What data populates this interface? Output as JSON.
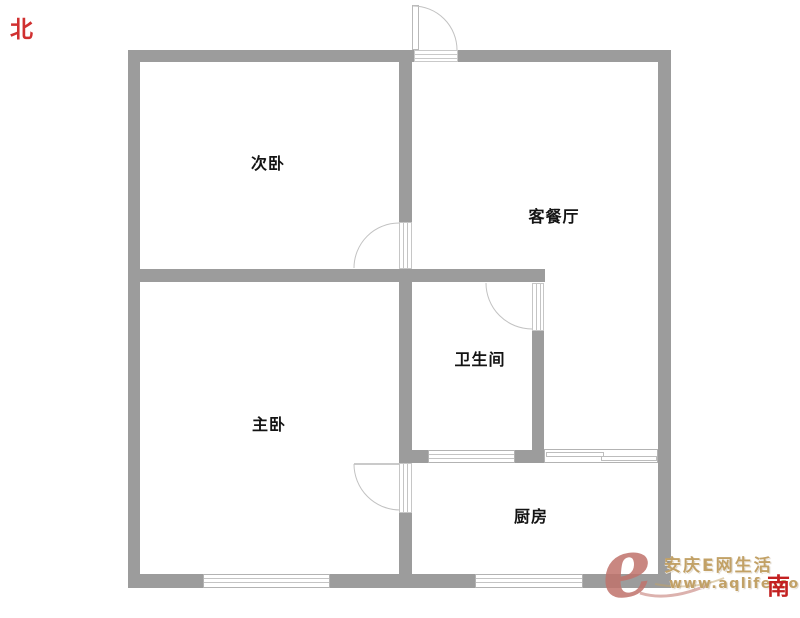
{
  "compass": {
    "north": "北",
    "south": "南",
    "color": "#d03030"
  },
  "rooms": [
    {
      "id": "secondary-bedroom",
      "label": "次卧"
    },
    {
      "id": "living-dining-room",
      "label": "客餐厅"
    },
    {
      "id": "bathroom",
      "label": "卫生间"
    },
    {
      "id": "master-bedroom",
      "label": "主卧"
    },
    {
      "id": "kitchen",
      "label": "厨房"
    }
  ],
  "watermark": {
    "logo": "e",
    "site_name": "安庆E网生活",
    "url": "www.aqlife.com",
    "logo_color": "#c0736c",
    "text_color": "#c2a166"
  },
  "plan": {
    "wall_color": "#9c9c9c",
    "door_line_color": "#c2c2c2",
    "background": "#ffffff"
  }
}
